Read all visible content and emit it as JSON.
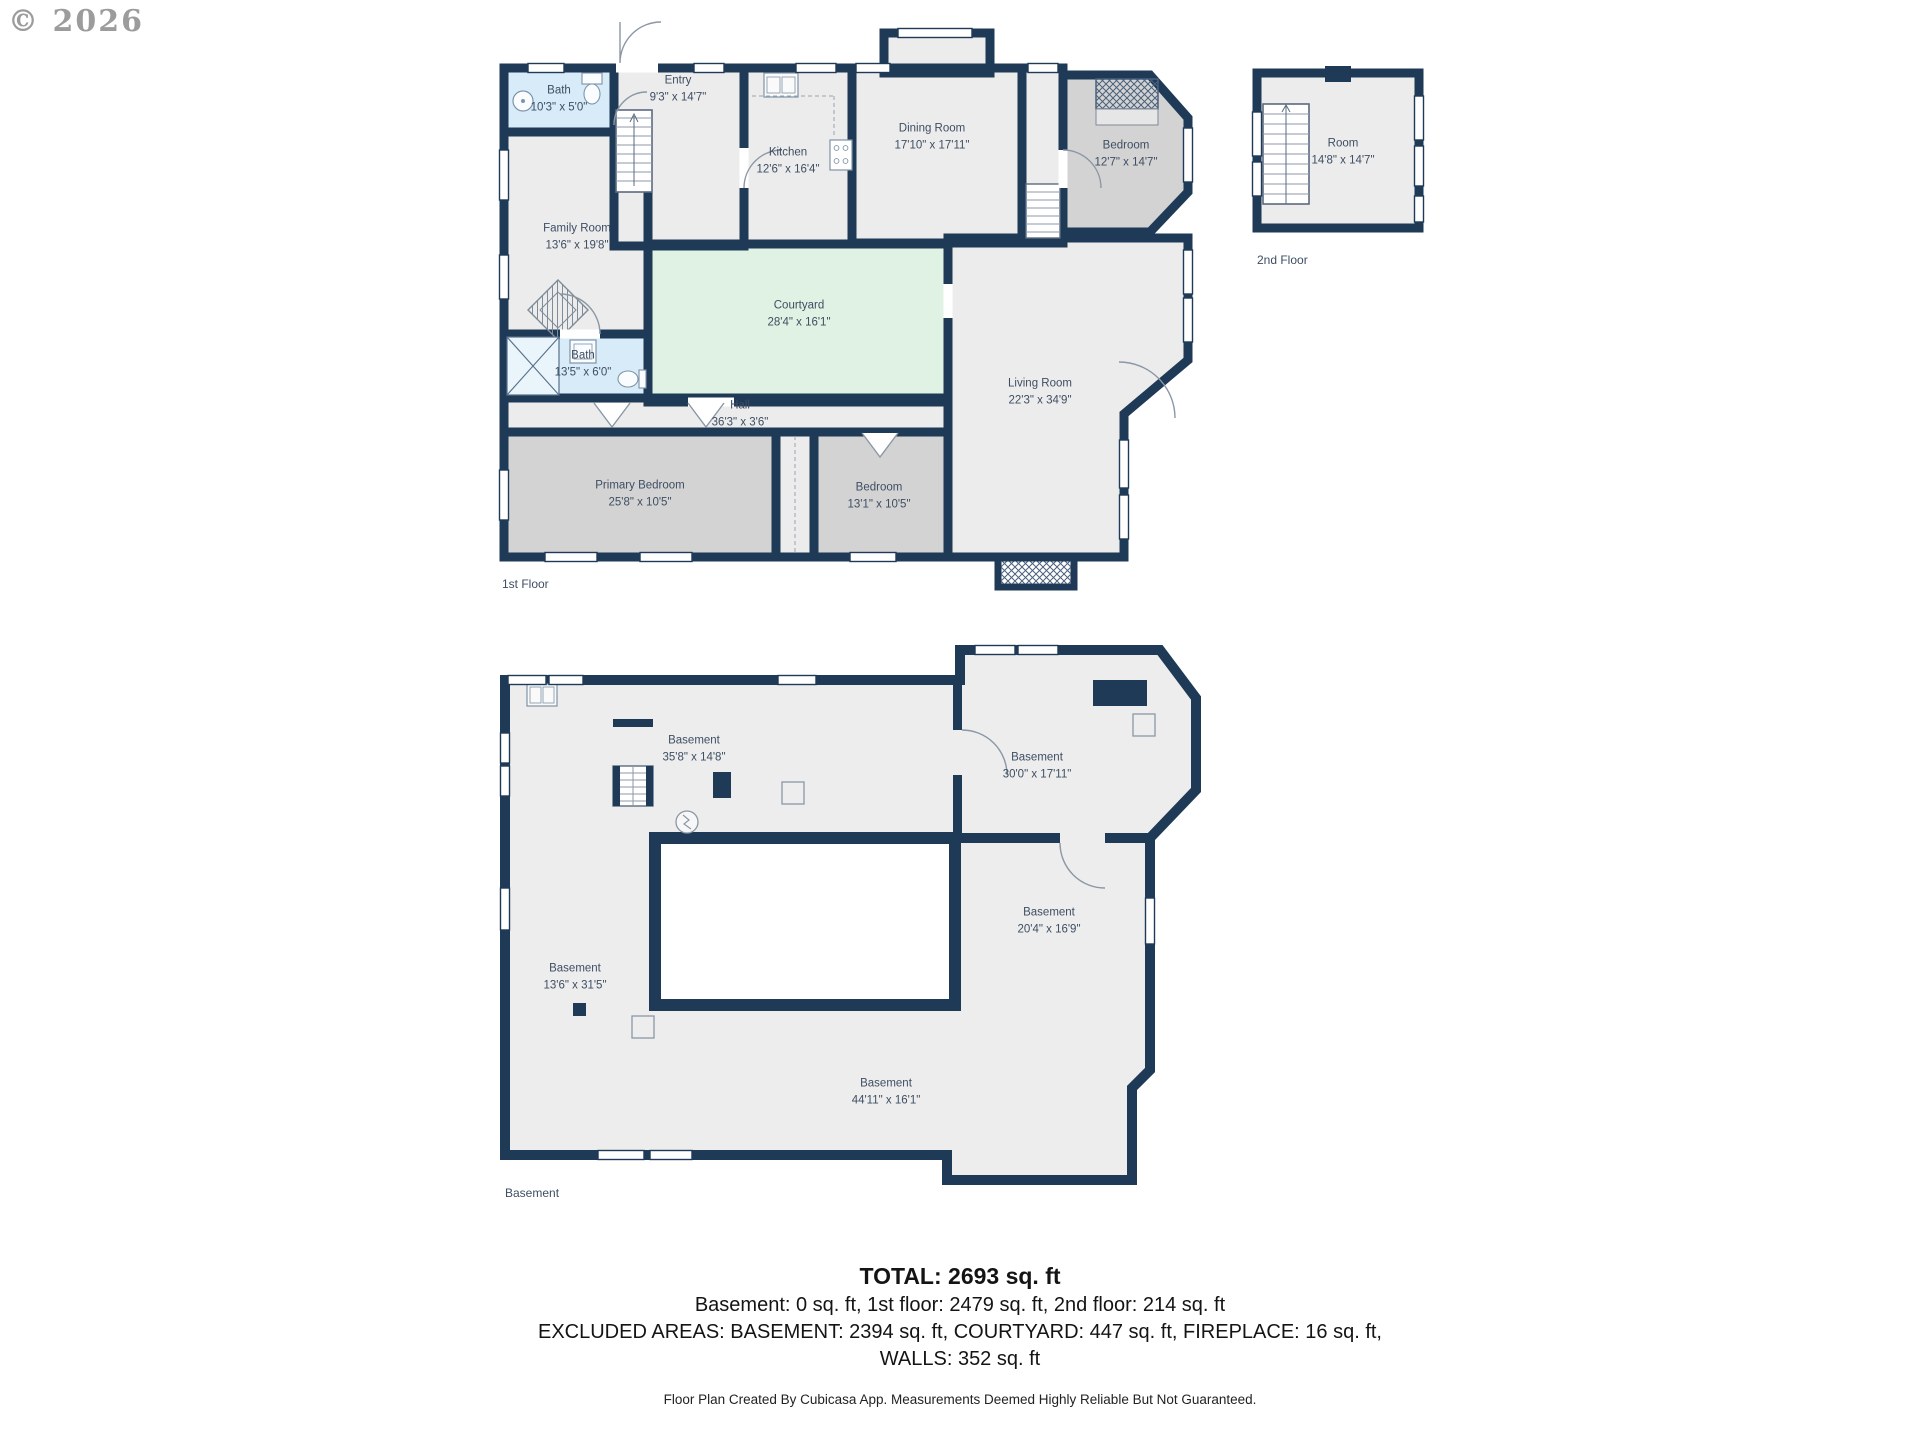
{
  "copyright": "© 2026",
  "colors": {
    "wall": "#1e3a56",
    "room_fill": "#ececec",
    "bedroom_fill": "#d3d3d3",
    "bath_fill": "#d7ebf8",
    "courtyard_fill": "#e0f2e3",
    "label_text": "#3e4e63"
  },
  "floors": {
    "first": {
      "label": "1st Floor",
      "rooms": [
        {
          "name": "Bath",
          "dims": "10'3\" x 5'0\""
        },
        {
          "name": "Entry",
          "dims": "9'3\" x 14'7\""
        },
        {
          "name": "Kitchen",
          "dims": "12'6\" x 16'4\""
        },
        {
          "name": "Dining Room",
          "dims": "17'10\" x 17'11\""
        },
        {
          "name": "Bedroom",
          "dims": "12'7\" x 14'7\""
        },
        {
          "name": "Family Room",
          "dims": "13'6\" x 19'8\""
        },
        {
          "name": "Courtyard",
          "dims": "28'4\" x 16'1\""
        },
        {
          "name": "Living Room",
          "dims": "22'3\" x 34'9\""
        },
        {
          "name": "Bath",
          "dims": "13'5\" x 6'0\""
        },
        {
          "name": "Hall",
          "dims": "36'3\" x 3'6\""
        },
        {
          "name": "Primary Bedroom",
          "dims": "25'8\" x 10'5\""
        },
        {
          "name": "Bedroom",
          "dims": "13'1\" x 10'5\""
        }
      ]
    },
    "second": {
      "label": "2nd Floor",
      "rooms": [
        {
          "name": "Room",
          "dims": "14'8\" x 14'7\""
        }
      ]
    },
    "basement": {
      "label": "Basement",
      "rooms": [
        {
          "name": "Basement",
          "dims": "35'8\" x 14'8\""
        },
        {
          "name": "Basement",
          "dims": "30'0\" x 17'11\""
        },
        {
          "name": "Basement",
          "dims": "20'4\" x 16'9\""
        },
        {
          "name": "Basement",
          "dims": "13'6\" x 31'5\""
        },
        {
          "name": "Basement",
          "dims": "44'11\" x 16'1\""
        }
      ]
    }
  },
  "summary": {
    "total": "TOTAL: 2693 sq. ft",
    "floors_line": "Basement: 0 sq. ft, 1st floor: 2479 sq. ft, 2nd floor: 214 sq. ft",
    "excluded_line1": "EXCLUDED AREAS: BASEMENT: 2394 sq. ft, COURTYARD: 447 sq. ft, FIREPLACE: 16 sq. ft,",
    "excluded_line2": "WALLS: 352 sq. ft"
  },
  "footer": "Floor Plan Created By Cubicasa App. Measurements Deemed Highly Reliable But Not Guaranteed."
}
